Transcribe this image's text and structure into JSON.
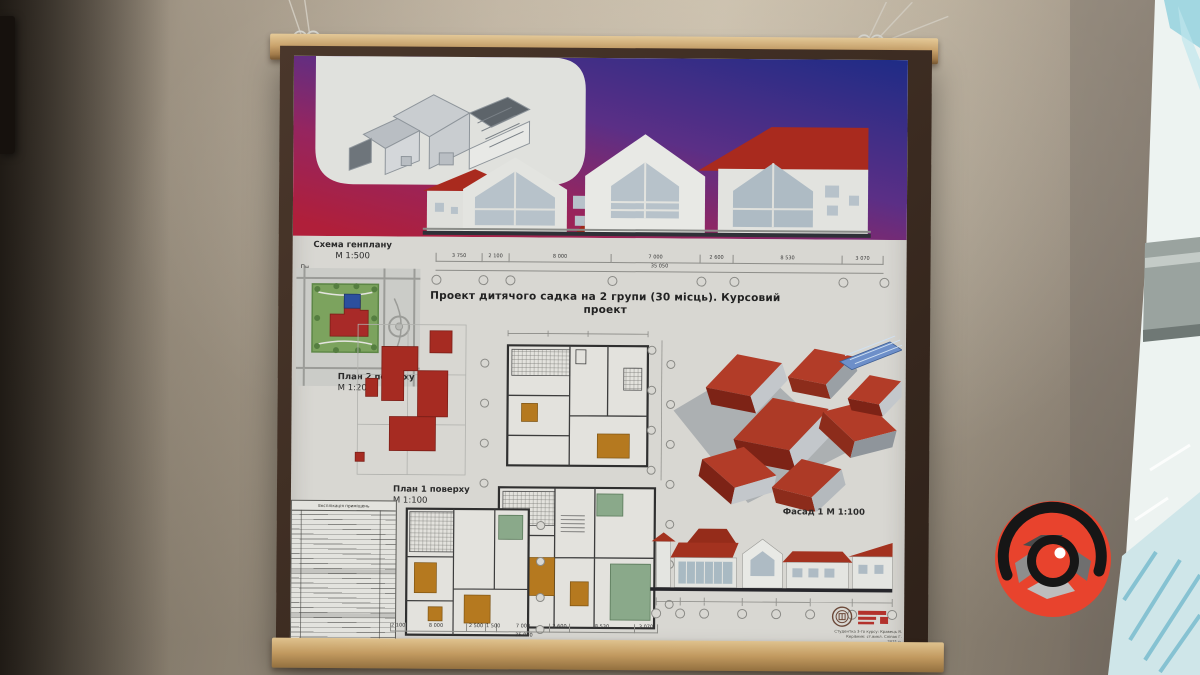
{
  "poster": {
    "title": "Проект дитячого садка на 2 групи (30 місць). Курсовий проект",
    "genplan": {
      "label": "Схема генплану",
      "scale": "М 1:500",
      "north": "Пн"
    },
    "plan2": {
      "label": "План 2 поверху",
      "scale": "М 1:200"
    },
    "plan1": {
      "label": "План 1 поверху",
      "scale": "М 1:100"
    },
    "facade": {
      "label": "Фасад 1 М 1:100"
    },
    "dims_top": {
      "segments": [
        "3 750",
        "2 100",
        "8 000",
        "7 000",
        "2 600",
        "8 530",
        "3 070"
      ],
      "total": "35 050"
    },
    "dims_bottom": {
      "segments": [
        "2 100",
        "8 000",
        "2 500",
        "1 500",
        "7 000",
        "2 600",
        "8 530",
        "3 070"
      ],
      "total": "35 050"
    },
    "legend": {
      "title": "Експлікація приміщень"
    },
    "stamp": {
      "line1": "Студентка 3-го курсу: Кравець Я.",
      "line2": "Керівник: ст.викл. Сліпак Г.",
      "line3": "2021 р."
    }
  },
  "colors": {
    "sky_blue": "#1e2c86",
    "sky_purple": "#5b2f86",
    "sky_red": "#b01f3a",
    "roof_red": "#a92a1e",
    "axon_roof_red": "#b23c28",
    "site_green": "#7ca35e",
    "room_green": "#8aa98a",
    "furniture_orange": "#b5791f",
    "wood": "#c9a878",
    "wall_beige": "#b2a693",
    "logo_red": "#e8432d"
  }
}
